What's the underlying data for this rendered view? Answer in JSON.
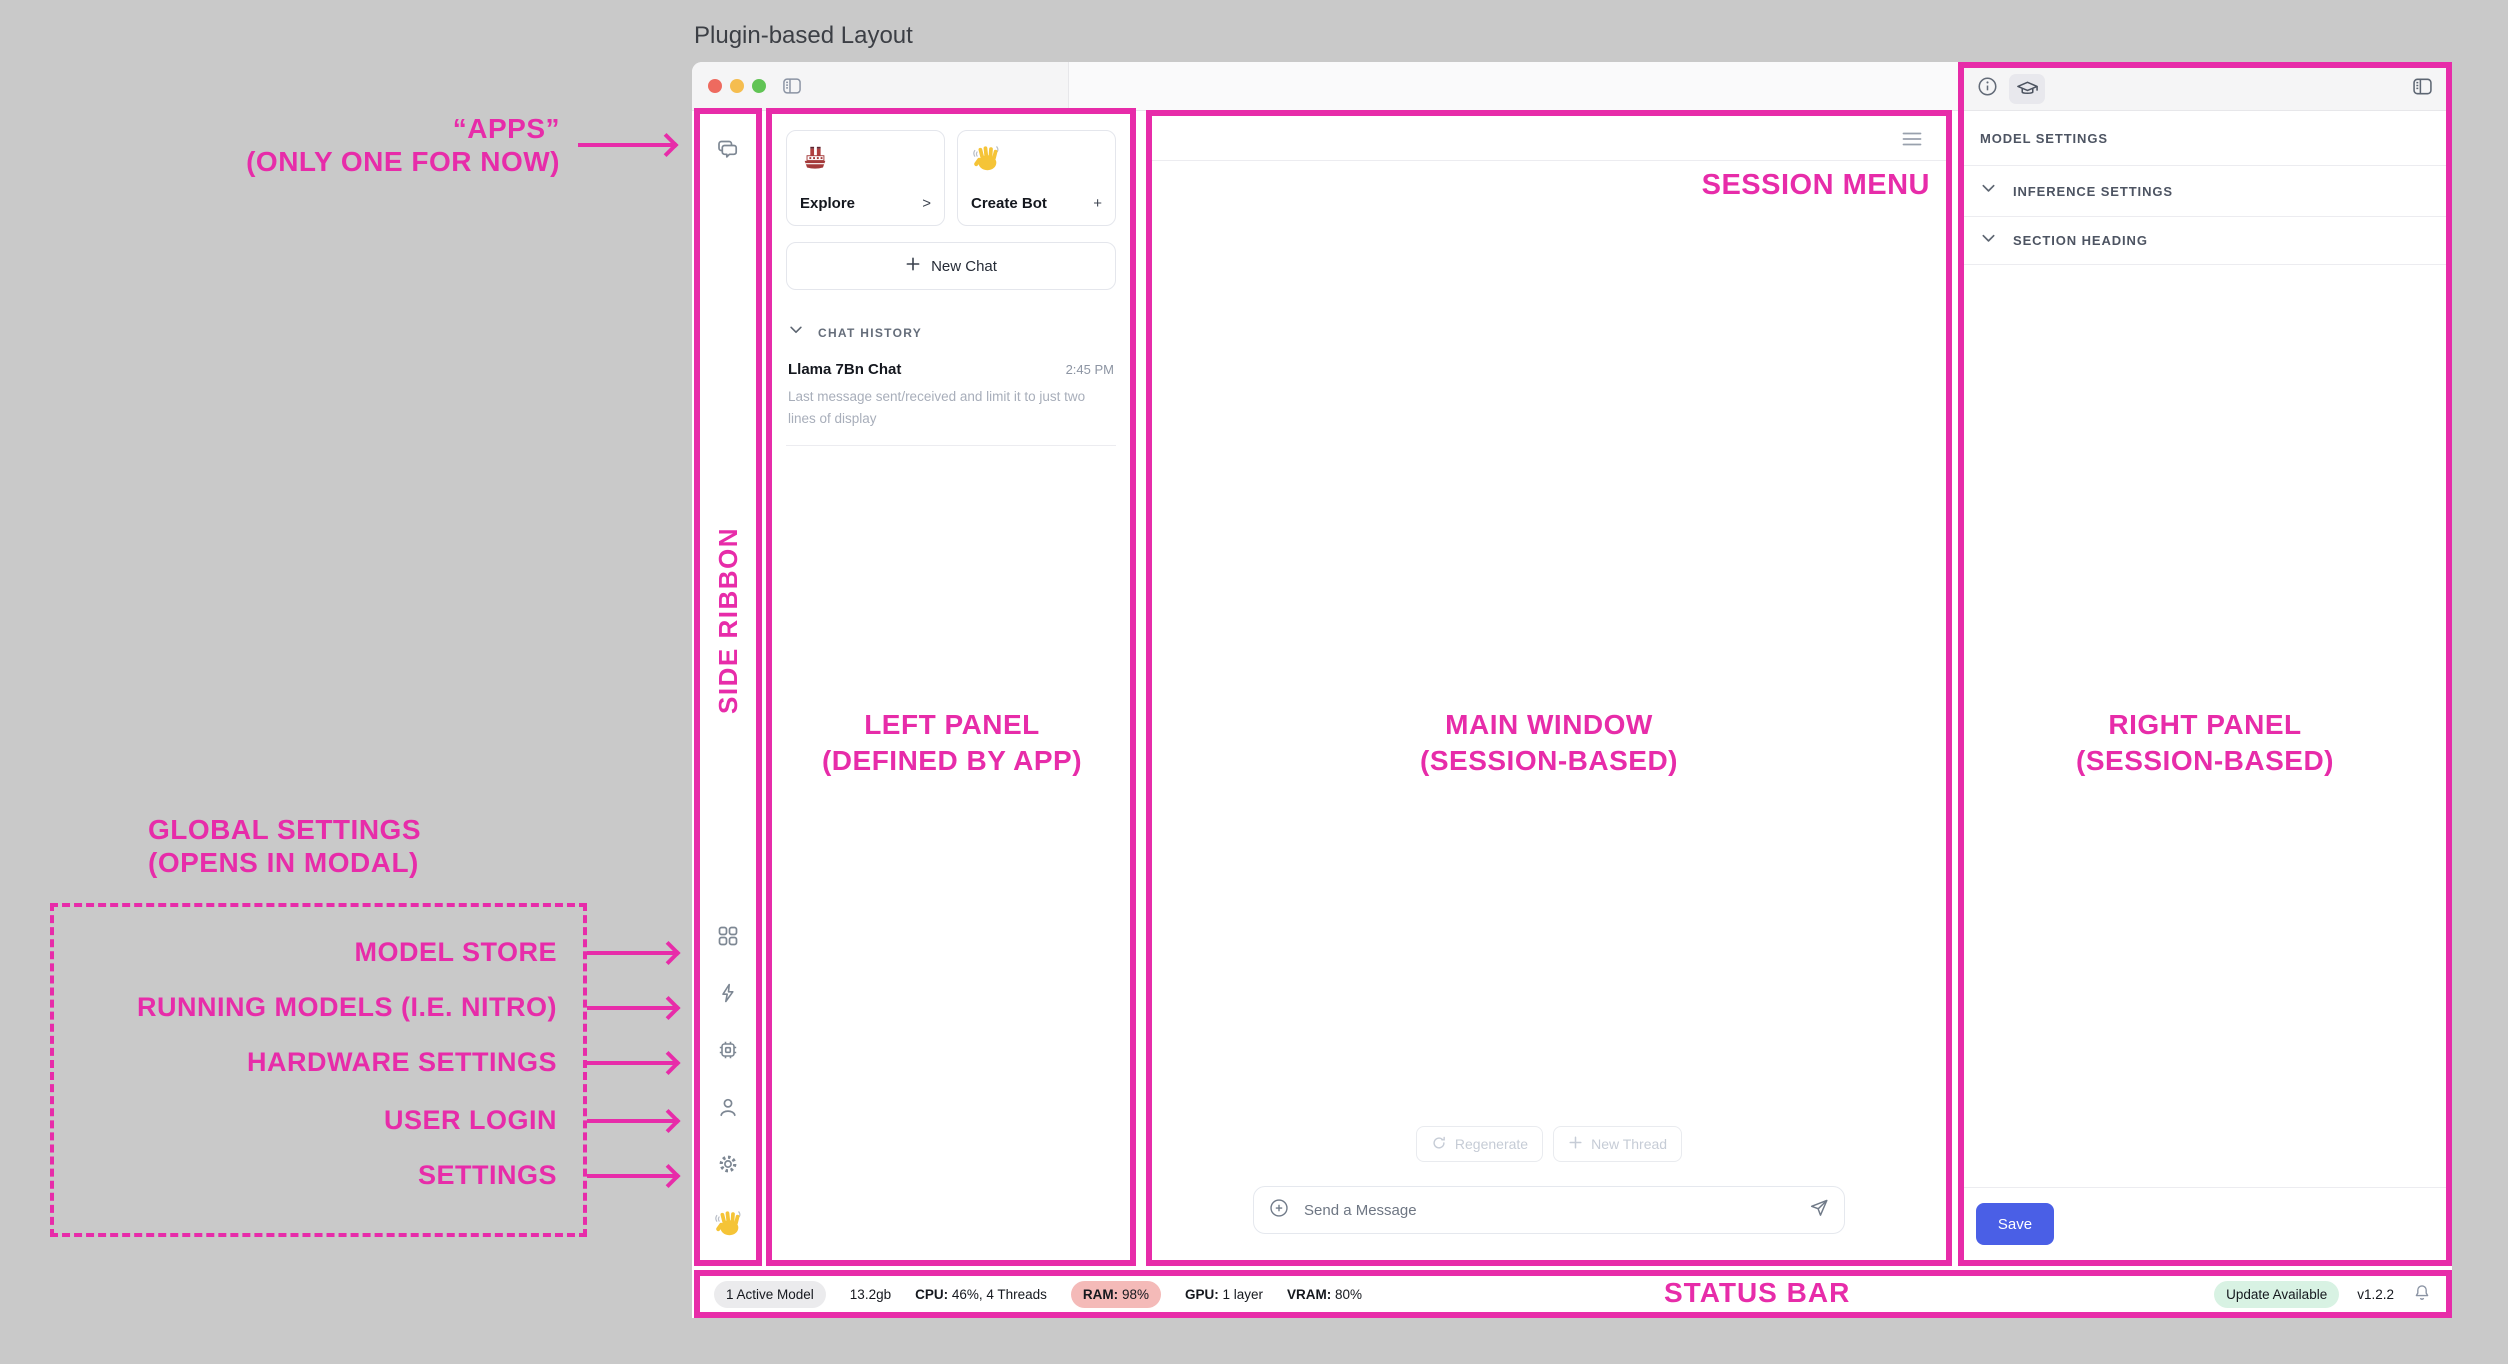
{
  "page": {
    "title": "Plugin-based Layout"
  },
  "colors": {
    "annotation_magenta": "#e72ca9",
    "canvas_gray": "#c9c9c9",
    "save_button_blue": "#4a5fe6",
    "ram_pill_red": "#f4bab8",
    "update_pill_green": "#d8f2e3"
  },
  "icons": {
    "titlebar": [
      "close-dot",
      "minimize-dot",
      "zoom-dot",
      "sidebar-toggle-icon"
    ],
    "side_ribbon": [
      "chat-bubbles-icon",
      "grid-apps-icon",
      "bolt-icon",
      "chip-icon",
      "user-icon",
      "gear-icon",
      "wave-hand-emoji"
    ],
    "left_panel": [
      "ship-emoji",
      "wave-hand-emoji",
      "plus-icon",
      "chevron-down-icon"
    ],
    "main_window": [
      "menu-icon",
      "refresh-icon",
      "plus-icon",
      "circle-plus-icon",
      "send-icon"
    ],
    "right_panel": [
      "info-icon",
      "graduation-cap-icon",
      "panel-toggle-icon",
      "chevron-down-icon"
    ],
    "status_bar": [
      "bell-icon"
    ]
  },
  "left_panel": {
    "cards": [
      {
        "icon": "ship-emoji",
        "label": "Explore",
        "affordance": ">"
      },
      {
        "icon": "wave-hand-emoji",
        "label": "Create Bot",
        "affordance": "+"
      }
    ],
    "new_chat": {
      "label": "New Chat"
    },
    "chat_history": {
      "header": "CHAT HISTORY",
      "items": [
        {
          "title": "Llama 7Bn Chat",
          "time": "2:45 PM",
          "preview": "Last message sent/received and limit it to just two lines of display"
        }
      ]
    }
  },
  "main_window": {
    "actions": {
      "regenerate": "Regenerate",
      "new_thread": "New Thread"
    },
    "composer": {
      "placeholder": "Send a Message"
    }
  },
  "right_panel": {
    "header_title": "MODEL SETTINGS",
    "sections": [
      {
        "label": "INFERENCE SETTINGS"
      },
      {
        "label": "SECTION HEADING"
      }
    ],
    "save": "Save"
  },
  "status_bar": {
    "active_model": "1 Active Model",
    "size": "13.2gb",
    "cpu": {
      "label": "CPU:",
      "value": "46%, 4 Threads"
    },
    "ram": {
      "label": "RAM:",
      "value": "98%"
    },
    "gpu": {
      "label": "GPU:",
      "value": "1 layer"
    },
    "vram": {
      "label": "VRAM:",
      "value": "80%"
    },
    "update": "Update Available",
    "version": "v1.2.2"
  },
  "annotations": {
    "apps": {
      "line1": "“APPS”",
      "line2": "(ONLY ONE FOR NOW)"
    },
    "side_ribbon": "SIDE RIBBON",
    "left_panel": {
      "line1": "LEFT PANEL",
      "line2": "(DEFINED BY APP)"
    },
    "main_window": {
      "line1": "MAIN WINDOW",
      "line2": "(SESSION-BASED)"
    },
    "right_panel": {
      "line1": "RIGHT PANEL",
      "line2": "(SESSION-BASED)"
    },
    "session_menu": "SESSION MENU",
    "status_bar": "STATUS BAR",
    "global_settings": {
      "line1": "GLOBAL SETTINGS",
      "line2": "(OPENS IN MODAL)"
    },
    "ribbon_targets": [
      "MODEL STORE",
      "RUNNING MODELS (I.E. NITRO)",
      "HARDWARE SETTINGS",
      "USER LOGIN",
      "SETTINGS"
    ]
  }
}
